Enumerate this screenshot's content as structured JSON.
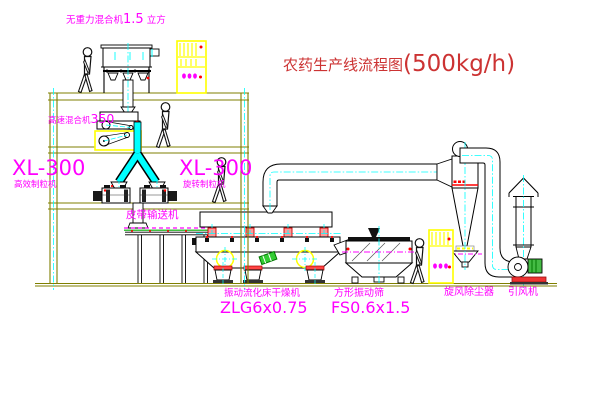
{
  "title": {
    "text": "农药生产线流程图",
    "capacity": "(500kg/h)"
  },
  "labels": {
    "gravity_mixer": {
      "name": "无重力混合机",
      "size": "1.5",
      "unit": " 立方"
    },
    "high_speed_mixer": {
      "name": "高速混合机",
      "size": "350"
    },
    "granulator_left": {
      "model": "XL-300",
      "name": "高效制粒机"
    },
    "granulator_right": {
      "model": "XL-300",
      "name": "旋转制粒机"
    },
    "belt_conveyor": {
      "name": "皮带输送机"
    },
    "fluid_bed_dryer": {
      "name": "振动流化床干燥机",
      "model": "ZLG6x0.75"
    },
    "square_sieve": {
      "name": "方形振动筛",
      "model": "FS0.6x1.5"
    },
    "cyclone": {
      "name": "旋风除尘器"
    },
    "induced_draft_fan": {
      "name": "引风机"
    }
  },
  "colors": {
    "label_magenta": "#ff00ff",
    "title_red": "#cc3333",
    "structure_olive": "#7f7f00",
    "centerline_cyan": "#00ffff",
    "highlight_yellow": "#ffff00",
    "detail_red": "#ff0000",
    "machine_black": "#000000",
    "motor_green": "#33bb33",
    "conveyor_green": "#00aa00"
  }
}
